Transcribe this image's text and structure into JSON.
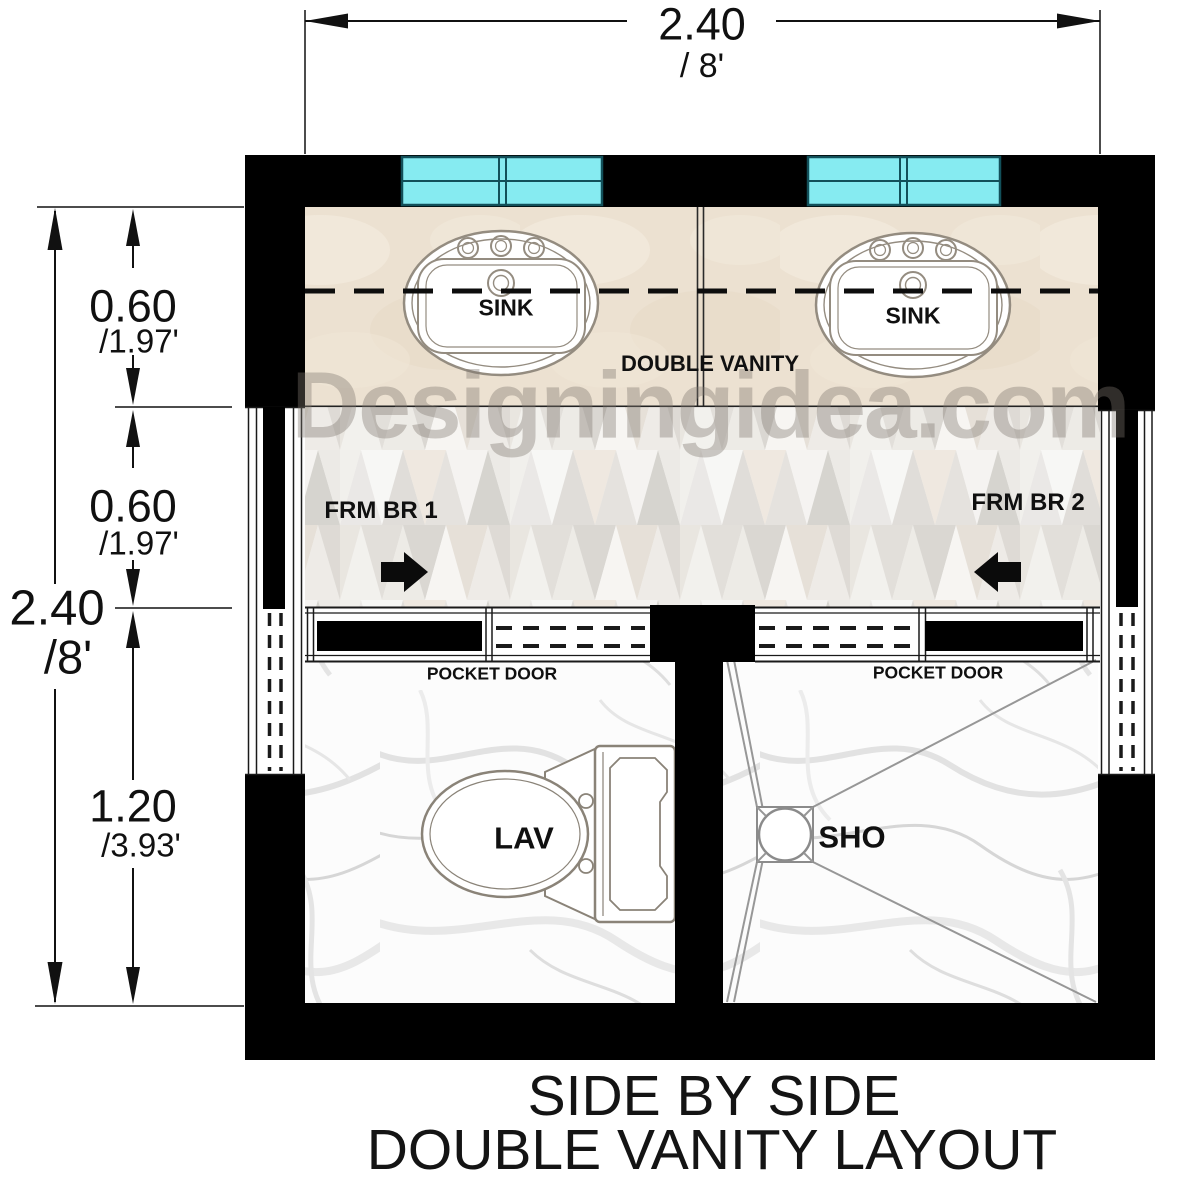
{
  "title": {
    "line1": "SIDE BY SIDE",
    "line2": "DOUBLE VANITY LAYOUT"
  },
  "watermark": {
    "text": "Designingidea.com"
  },
  "dimensions": {
    "top_width": {
      "metric": "2.40",
      "imperial": "/ 8'"
    },
    "left_total_height": {
      "metric": "2.40",
      "imperial": "/8'"
    },
    "vanity_depth": {
      "metric": "0.60",
      "imperial": "/1.97'"
    },
    "hallway_depth": {
      "metric": "0.60",
      "imperial": "/1.97'"
    },
    "wet_rooms_depth": {
      "metric": "1.20",
      "imperial": "/3.93'"
    }
  },
  "labels": {
    "sink_left": "SINK",
    "sink_right": "SINK",
    "double_vanity": "DOUBLE VANITY",
    "from_bedroom_1": "FRM BR 1",
    "from_bedroom_2": "FRM BR 2",
    "pocket_door_left": "POCKET DOOR",
    "pocket_door_right": "POCKET DOOR",
    "toilet": "LAV",
    "shower": "SHO"
  },
  "colors": {
    "wall": "#000000",
    "window_glass": "#86ebf1",
    "window_frame": "#12505a",
    "vanity_counter": "#ece1d1",
    "dimension": "#111111"
  }
}
